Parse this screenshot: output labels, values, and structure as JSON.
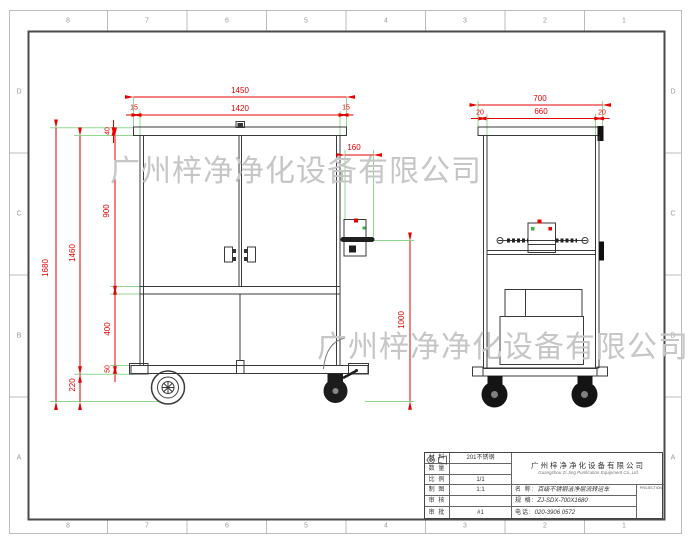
{
  "frame": {
    "top_zones": [
      "8",
      "7",
      "6",
      "5",
      "4",
      "3",
      "2",
      "1"
    ],
    "bottom_zones": [
      "8",
      "7",
      "6",
      "5",
      "4",
      "3",
      "2",
      "1"
    ],
    "left_zones": [
      "D",
      "C",
      "B",
      "A"
    ],
    "right_zones": [
      "D",
      "C",
      "B",
      "A"
    ]
  },
  "watermark": {
    "text": "广州梓净净化设备有限公司",
    "color": "#c6c6c6"
  },
  "colors": {
    "dimension_red": "#e60000",
    "extension_green": "#90d890",
    "line_dark": "#3a3a3a"
  },
  "front_view": {
    "dims": {
      "width_total": "1450",
      "width_inner": "1420",
      "margin_left": "15",
      "margin_right": "15",
      "cap_height": "40",
      "door_height": "900",
      "body_height": "1460",
      "total_height": "1680",
      "lower_panel_height": "400",
      "base_height": "50",
      "ground_clearance": "220",
      "side_box_width": "160",
      "side_box_height": "1000"
    }
  },
  "side_view": {
    "dims": {
      "width_total": "700",
      "width_inner": "660",
      "margin_left": "20",
      "margin_right": "20"
    }
  },
  "title_block": {
    "info_rows": [
      {
        "label": "材 料",
        "value": "201不锈钢"
      },
      {
        "label": "数 量",
        "value": ""
      },
      {
        "label": "比 例",
        "value": "1/1"
      },
      {
        "label": "制 图",
        "value": "1:1"
      },
      {
        "label": "审 核",
        "value": ""
      },
      {
        "label": "审 批",
        "value": "#1"
      }
    ],
    "company_cn": "广州梓净净化设备有限公司",
    "company_en": "Guangzhou Zi Jing Purification Equipment Co.,Ltd",
    "name_label": "名 称:",
    "name_value": "百级不锈钢洁净层流转运车",
    "spec_label": "规 格:",
    "spec_value": "ZJ-SDX-700X1680",
    "phone_label": "电话:",
    "phone_value": "020-3906 0572",
    "projection_caption": "PROJECTION"
  }
}
